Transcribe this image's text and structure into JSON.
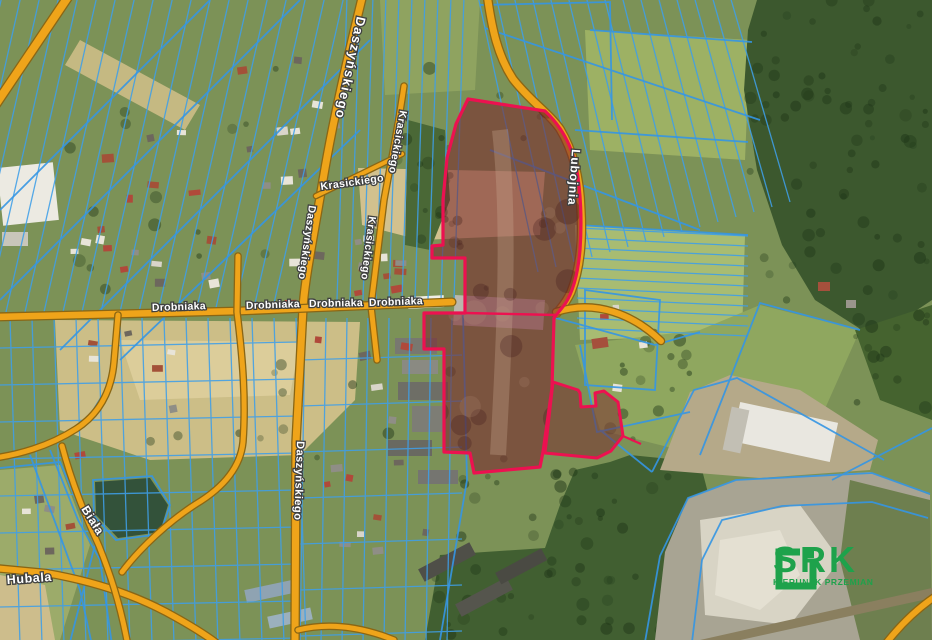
{
  "map": {
    "street_labels": [
      {
        "id": "daszynskiego-top",
        "text": "Daszyńskiego"
      },
      {
        "id": "daszynskiego-mid",
        "text": "Daszyńskiego"
      },
      {
        "id": "daszynskiego-bottom",
        "text": "Daszyńskiego"
      },
      {
        "id": "krasickiego-top",
        "text": "Krasickiego"
      },
      {
        "id": "krasickiego-mid",
        "text": "Krasickiego"
      },
      {
        "id": "krasickiego-diagonal",
        "text": "Krasickiego"
      },
      {
        "id": "drobniaka-1",
        "text": "Drobniaka"
      },
      {
        "id": "drobniaka-2",
        "text": "Drobniaka"
      },
      {
        "id": "drobniaka-3",
        "text": "Drobniaka"
      },
      {
        "id": "drobniaka-4",
        "text": "Drobniaka"
      },
      {
        "id": "lubojnia",
        "text": "Lubojnia"
      },
      {
        "id": "biala",
        "text": "Biała"
      },
      {
        "id": "hubala",
        "text": "Hubala"
      }
    ],
    "colors": {
      "highlight_parcel_red": "#ec1150",
      "cadastral_blue": "#3f9fe8",
      "road_orange": "#efa41a",
      "forest_green": "#3c582e"
    }
  },
  "logo": {
    "name": "SRK",
    "tagline": "KIERUNEK PRZEMIAN",
    "color": "#1ea24b"
  }
}
